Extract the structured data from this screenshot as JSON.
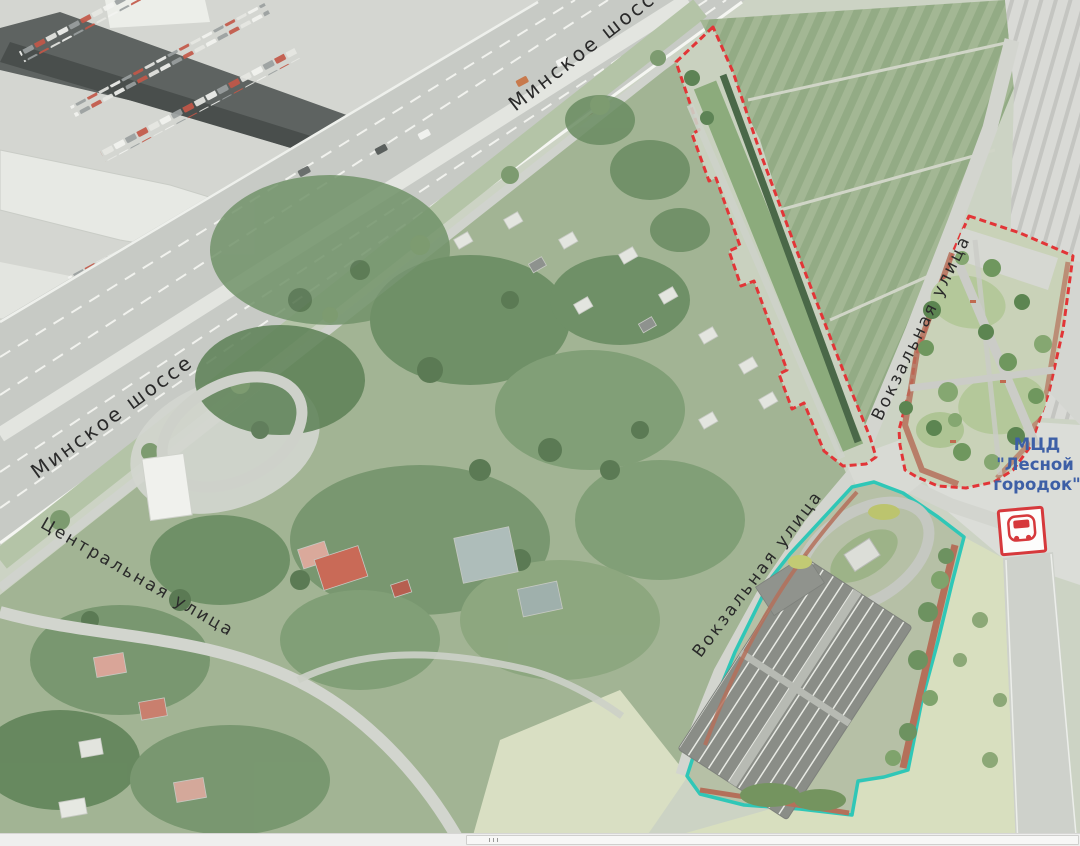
{
  "map": {
    "street_labels": {
      "minsk_highway_top": "Минское шоссе",
      "minsk_highway_left": "Минское шоссе",
      "central_street": "Центральная улица",
      "vokzalnaya_upper": "Вокзальная улица",
      "vokzalnaya_lower": "Вокзальная улица"
    },
    "station": {
      "line1": "МЦД",
      "line2": "\"Лесной",
      "line3": "городок\"",
      "icon": "mcd-train-station-icon",
      "label_color": "#3d5fa6"
    },
    "boundaries": {
      "red_sites_color": "#e23537",
      "cyan_site_color": "#2fc7b7"
    }
  }
}
